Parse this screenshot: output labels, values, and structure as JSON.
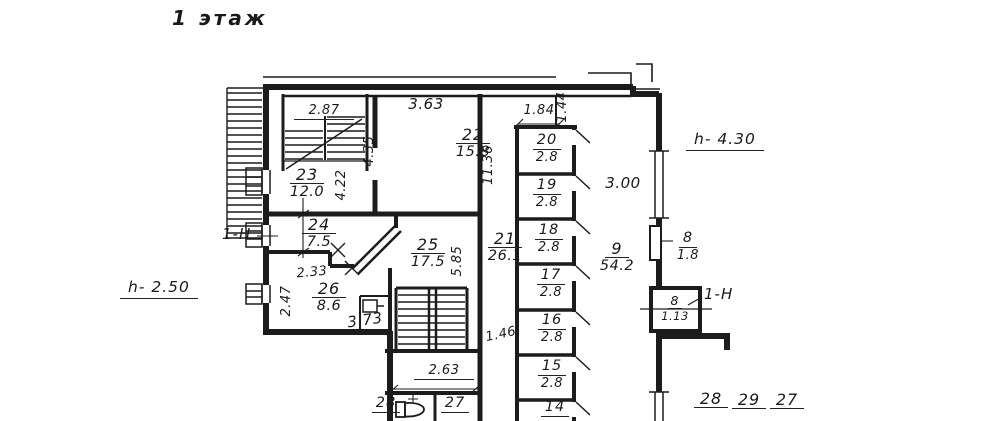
{
  "title": "1 этаж",
  "annotations": {
    "height_right": "h- 4.30",
    "height_left": "h- 2.50",
    "unit_mark_left": "1-Н",
    "unit_mark_right": "1-Н"
  },
  "rooms": {
    "r22": {
      "num": "22",
      "area": "15.8"
    },
    "r23": {
      "num": "23",
      "area": "12.0"
    },
    "r24": {
      "num": "24",
      "area": "7.5"
    },
    "r25": {
      "num": "25",
      "area": "17.5"
    },
    "r26": {
      "num": "26",
      "area": "8.6"
    },
    "r21": {
      "num": "21",
      "area": "26.1"
    },
    "r20": {
      "num": "20",
      "area": "2.8"
    },
    "r19": {
      "num": "19",
      "area": "2.8"
    },
    "r18": {
      "num": "18",
      "area": "2.8"
    },
    "r17": {
      "num": "17",
      "area": "2.8"
    },
    "r16": {
      "num": "16",
      "area": "2.8"
    },
    "r15": {
      "num": "15",
      "area": "2.8"
    },
    "r14": {
      "num": "14"
    },
    "r9": {
      "num": "9",
      "area": "54.2"
    },
    "r8a": {
      "num": "8",
      "area": "1.8"
    },
    "r8b": {
      "num": "8",
      "area": "1.13"
    },
    "r27": {
      "num": "27"
    },
    "r28": {
      "num": "28"
    },
    "b28": {
      "num": "28"
    },
    "b29": {
      "num": "29"
    },
    "b27": {
      "num": "27"
    }
  },
  "dims": {
    "d2_87": "2.87",
    "d3_63": "3.63",
    "d4_35": "4.35",
    "d4_22": "4.22",
    "d1_84": "1.84",
    "d1_44": "1.44",
    "d11_36": "11.36",
    "d3_00": "3.00",
    "d2_33": "2.33",
    "d2_47": "2.47",
    "d3_73": "3.73",
    "d5_85": "5.85",
    "d1_46": "1.46",
    "d2_63": "2.63"
  }
}
